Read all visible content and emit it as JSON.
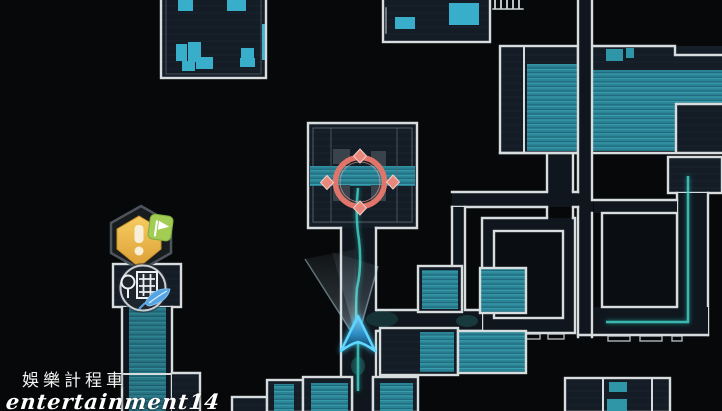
{
  "watermark": {
    "line1": "娛樂計程車",
    "line2": "entertainment14"
  },
  "map": {
    "markers": {
      "objective": {
        "name": "exclamation-quest-marker",
        "glyph": "!",
        "badge": "flag-badge",
        "hex_color": "#eec257",
        "badge_color": "#a3cc55"
      },
      "location": {
        "name": "district-location-icon",
        "elements": [
          "building",
          "tree",
          "feather"
        ],
        "feather_color": "#55a5e5"
      },
      "target_ring": {
        "color": "#e2756b",
        "x": 360,
        "y": 182
      },
      "player": {
        "color": "#5fd7ff",
        "x": 358,
        "y": 341,
        "facing": "up"
      }
    },
    "colors": {
      "background": "#060809",
      "room_fill": "#141c25",
      "room_stroke": "#d7dcdf",
      "teal_floor": "#2b8496",
      "bright_cyan": "#38aecb",
      "trail": "#45e0d6"
    }
  }
}
